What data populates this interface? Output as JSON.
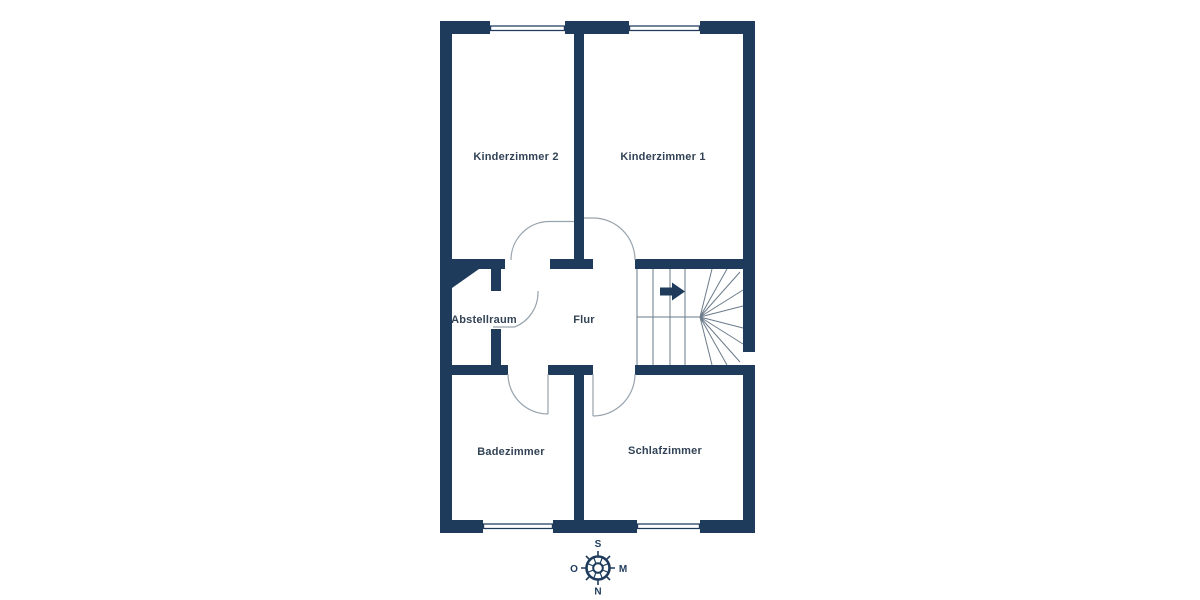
{
  "floorplan": {
    "rooms": [
      {
        "id": "kinderzimmer-2",
        "label": "Kinderzimmer 2"
      },
      {
        "id": "kinderzimmer-1",
        "label": "Kinderzimmer 1"
      },
      {
        "id": "abstellraum",
        "label": "Abstellraum"
      },
      {
        "id": "flur",
        "label": "Flur"
      },
      {
        "id": "badezimmer",
        "label": "Badezimmer"
      },
      {
        "id": "schlafzimmer",
        "label": "Schlafzimmer"
      }
    ],
    "compass": {
      "top": "S",
      "right": "M",
      "bottom": "N",
      "left": "O"
    },
    "colors": {
      "wall": "#1e3b5c",
      "stair_line": "#6b7b8a",
      "door_arc": "#97a3ad",
      "label_text": "#324356",
      "background": "#ffffff"
    }
  }
}
